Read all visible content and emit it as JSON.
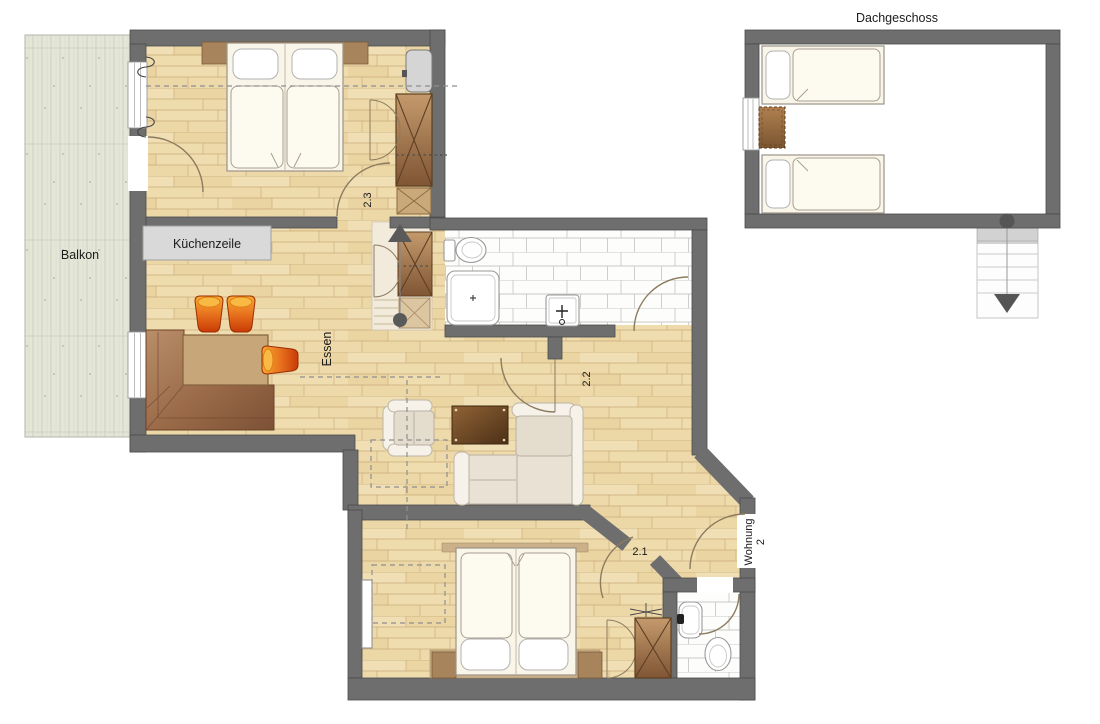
{
  "floorplan": {
    "attic_title": "Dachgeschoss",
    "labels": {
      "balcony": "Balkon",
      "kitchenette": "Küchenzeile",
      "dining": "Essen",
      "room_2_3": "2.3",
      "room_2_2": "2.2",
      "room_2_1": "2.1",
      "apartment_name": "Wohnung",
      "apartment_number": "2"
    },
    "colors": {
      "wall": "#6e6e6e",
      "parquet_floor": "#ecd9ab",
      "balcony_deck": "#e4e6d7",
      "bathroom_tile": "#fdfdfc",
      "kitchen_counter": "#d9d9d9",
      "furniture_wood": "#a8845c",
      "stool_orange": "#e8731e",
      "stair_marker": "#5a5a5a"
    }
  }
}
